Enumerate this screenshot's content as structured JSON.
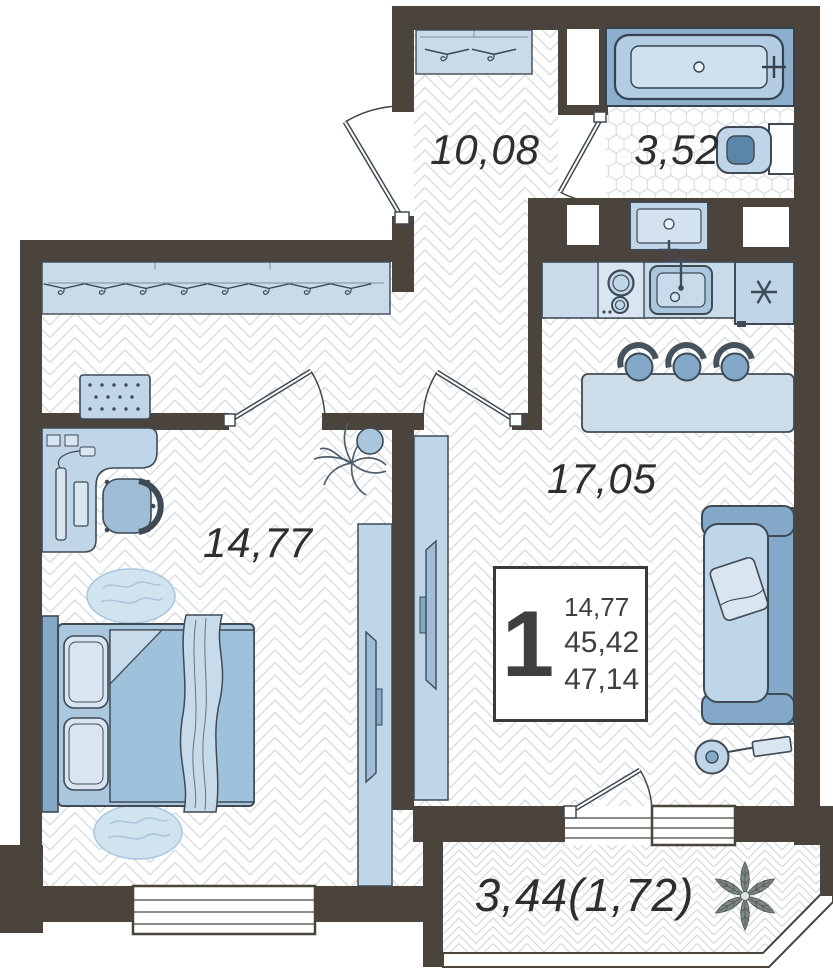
{
  "floor_plan": {
    "rooms": [
      {
        "key": "entry_hall",
        "area_label": "10,08"
      },
      {
        "key": "bathroom",
        "area_label": "3,52"
      },
      {
        "key": "kitchen_living_room",
        "area_label": "17,05"
      },
      {
        "key": "bedroom",
        "area_label": "14,77"
      },
      {
        "key": "balcony",
        "area_label": "3,44(1,72)"
      }
    ],
    "summary_box": {
      "rooms_count": "1",
      "values": [
        "14,77",
        "45,42",
        "47,14"
      ]
    },
    "palette": {
      "wall": "#4a443d",
      "furniture_light": "#d9e6f1",
      "furniture": "#c0d6e8",
      "furniture_medium": "#a9c6de",
      "furniture_dark": "#83a8c8",
      "furniture_darkest": "#5c85aa",
      "floor_line": "#d5dade",
      "text": "#2e2e2e"
    }
  }
}
